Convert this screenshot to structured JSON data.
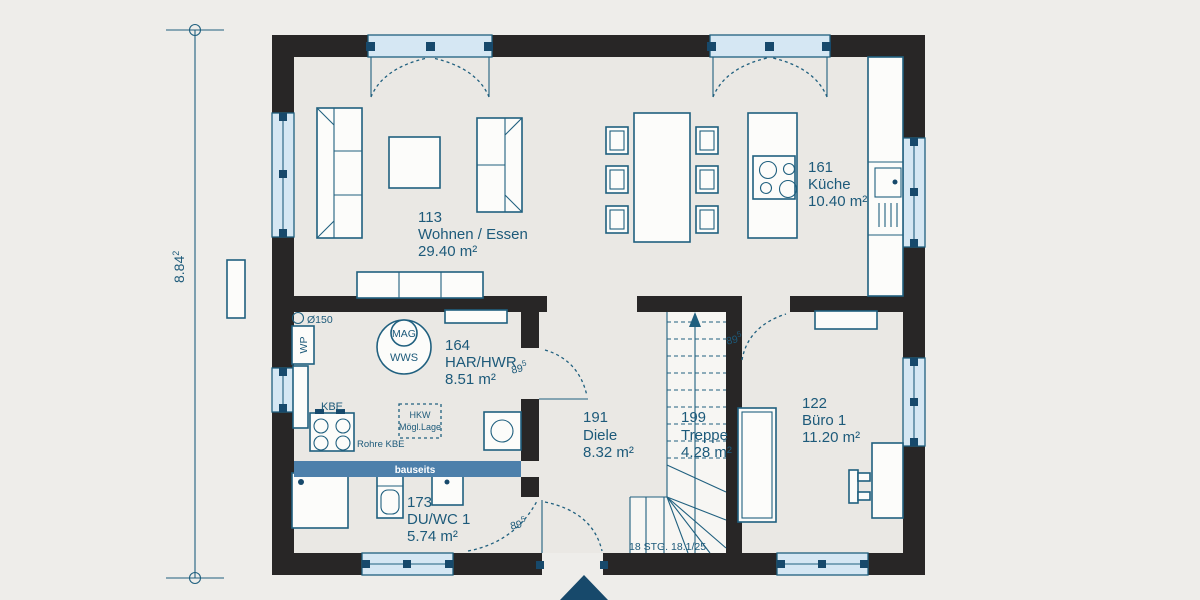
{
  "colors": {
    "background": "#eeedea",
    "floor": "#eae8e4",
    "wall": "#282626",
    "line": "#20607f",
    "text": "#1d5a7a",
    "window_fill": "#d5e7f3",
    "marker": "#17496b",
    "bauseits_fill": "#4d80ab",
    "stair_fill": "#f7f6f3",
    "white_fill": "#fcfcfa",
    "arrow": "#17496b"
  },
  "dimension": {
    "value": "8.84",
    "sup": "2"
  },
  "rooms": {
    "wohnen": {
      "number": "113",
      "name": "Wohnen / Essen",
      "area": "29.40 m²"
    },
    "kueche": {
      "number": "161",
      "name": "Küche",
      "area": "10.40 m²"
    },
    "har": {
      "number": "164",
      "name": "HAR/HWR",
      "area": "8.51 m²"
    },
    "diele": {
      "number": "191",
      "name": "Diele",
      "area": "8.32 m²"
    },
    "treppe": {
      "number": "199",
      "name": "Treppe",
      "area": "4.28 m²"
    },
    "buero": {
      "number": "122",
      "name": "Büro 1",
      "area": "11.20 m²"
    },
    "duwc": {
      "number": "173",
      "name": "DU/WC 1",
      "area": "5.74 m²"
    }
  },
  "annotations": {
    "door_width": "89",
    "door_width_sup": "5",
    "stair_note": "18 STG. 18.1/25",
    "bauseits": "bauseits",
    "duct": "Ø150",
    "heat_pump": "WP",
    "mag": "MAG",
    "wws": "WWS",
    "kbe": "KBE",
    "rohre_kbe": "Rohre KBE",
    "hkw_line1": "HKW",
    "hkw_line2": "Mögl.Lage"
  }
}
